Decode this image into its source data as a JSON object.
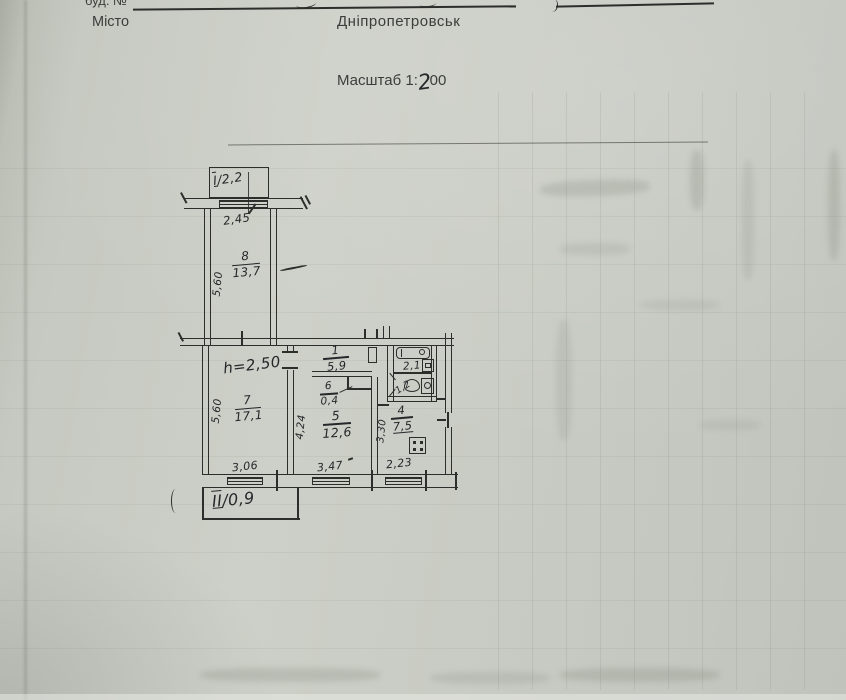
{
  "header": {
    "bud_label": "буд. №",
    "misto_label": "Місто",
    "city": "Дніпропетровськ",
    "scale_label": "Масштаб 1",
    "scale_colon": ":",
    "scale_hand_digit": "2",
    "scale_tail": "00"
  },
  "plan": {
    "slash": "/",
    "height_note": "h=2,50",
    "balcony_top": {
      "num": "I",
      "area": "2,2"
    },
    "balcony_bottom": {
      "num": "II",
      "area": "0,9"
    },
    "rooms": {
      "r1_hall": {
        "num": "1",
        "area": "5,9"
      },
      "r4_kitchen": {
        "num": "4",
        "area": "7,5"
      },
      "r5_living": {
        "num": "5",
        "area": "12,6"
      },
      "r6_closet": {
        "num": "6",
        "area": "0,4"
      },
      "r7_room": {
        "num": "7",
        "area": "17,1"
      },
      "r8_room": {
        "num": "8",
        "area": "13,7"
      }
    },
    "wet": {
      "bath_area": "2,1",
      "wc_area": "1,2"
    },
    "dims": {
      "top_window_width": "2,45",
      "corridor_depth": "5,60",
      "room7_depth": "5,60",
      "room7_width": "3,06",
      "room5_depth": "4,24",
      "room5_width": "3,47",
      "kitchen_depth": "3,30",
      "kitchen_width": "2,23"
    },
    "ink_color": "#2b2e2b",
    "paper_color": "#c8cbc3"
  }
}
